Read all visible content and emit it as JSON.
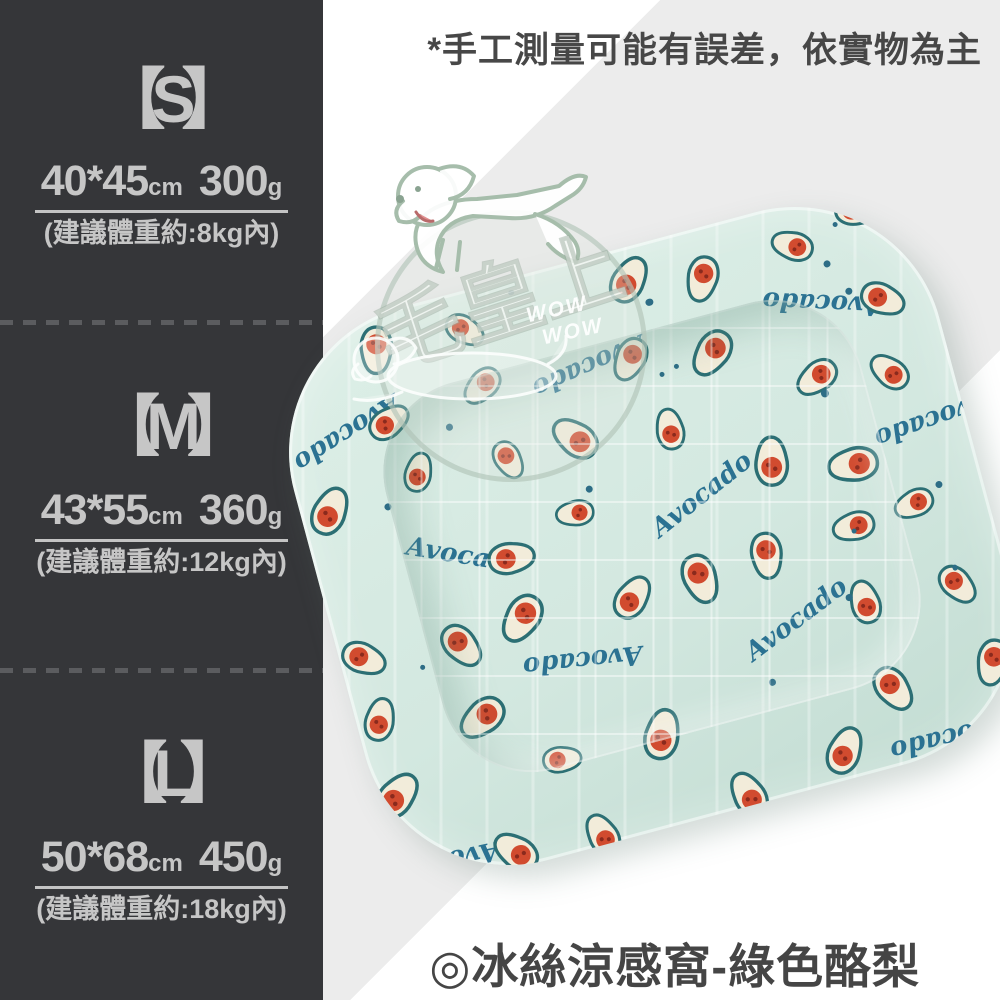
{
  "header": {
    "disclaimer": "*手工測量可能有誤差，依實物為主"
  },
  "footer": {
    "product_title": "◎冰絲涼感窩-綠色酪梨"
  },
  "size_panel": {
    "sizes": [
      {
        "label": "【S】",
        "dims": "40*45",
        "dim_unit": "cm",
        "weight": "300",
        "weight_unit": "g",
        "note": "(建議體重約:8kg內)"
      },
      {
        "label": "【M】",
        "dims": "43*55",
        "dim_unit": "cm",
        "weight": "360",
        "weight_unit": "g",
        "note": "(建議體重約:12kg內)"
      },
      {
        "label": "【L】",
        "dims": "50*68",
        "dim_unit": "cm",
        "weight": "450",
        "weight_unit": "g",
        "note": "(建議體重約:18kg內)"
      }
    ]
  },
  "watermark": {
    "brand": "毛皇上",
    "wow_line1": "WOW",
    "wow_line2": "WOW"
  },
  "product_photo": {
    "pattern_word": "Avocado"
  },
  "colors": {
    "sidebar_bg": "#353639",
    "sidebar_text": "#c6c6c6",
    "bg_gray_band": "#ececec",
    "fabric_mint": "#d3e8e0",
    "pattern_teal": "#2b7292",
    "avocado_pit_red": "#d14b2f",
    "overlay_text": "#474747"
  }
}
